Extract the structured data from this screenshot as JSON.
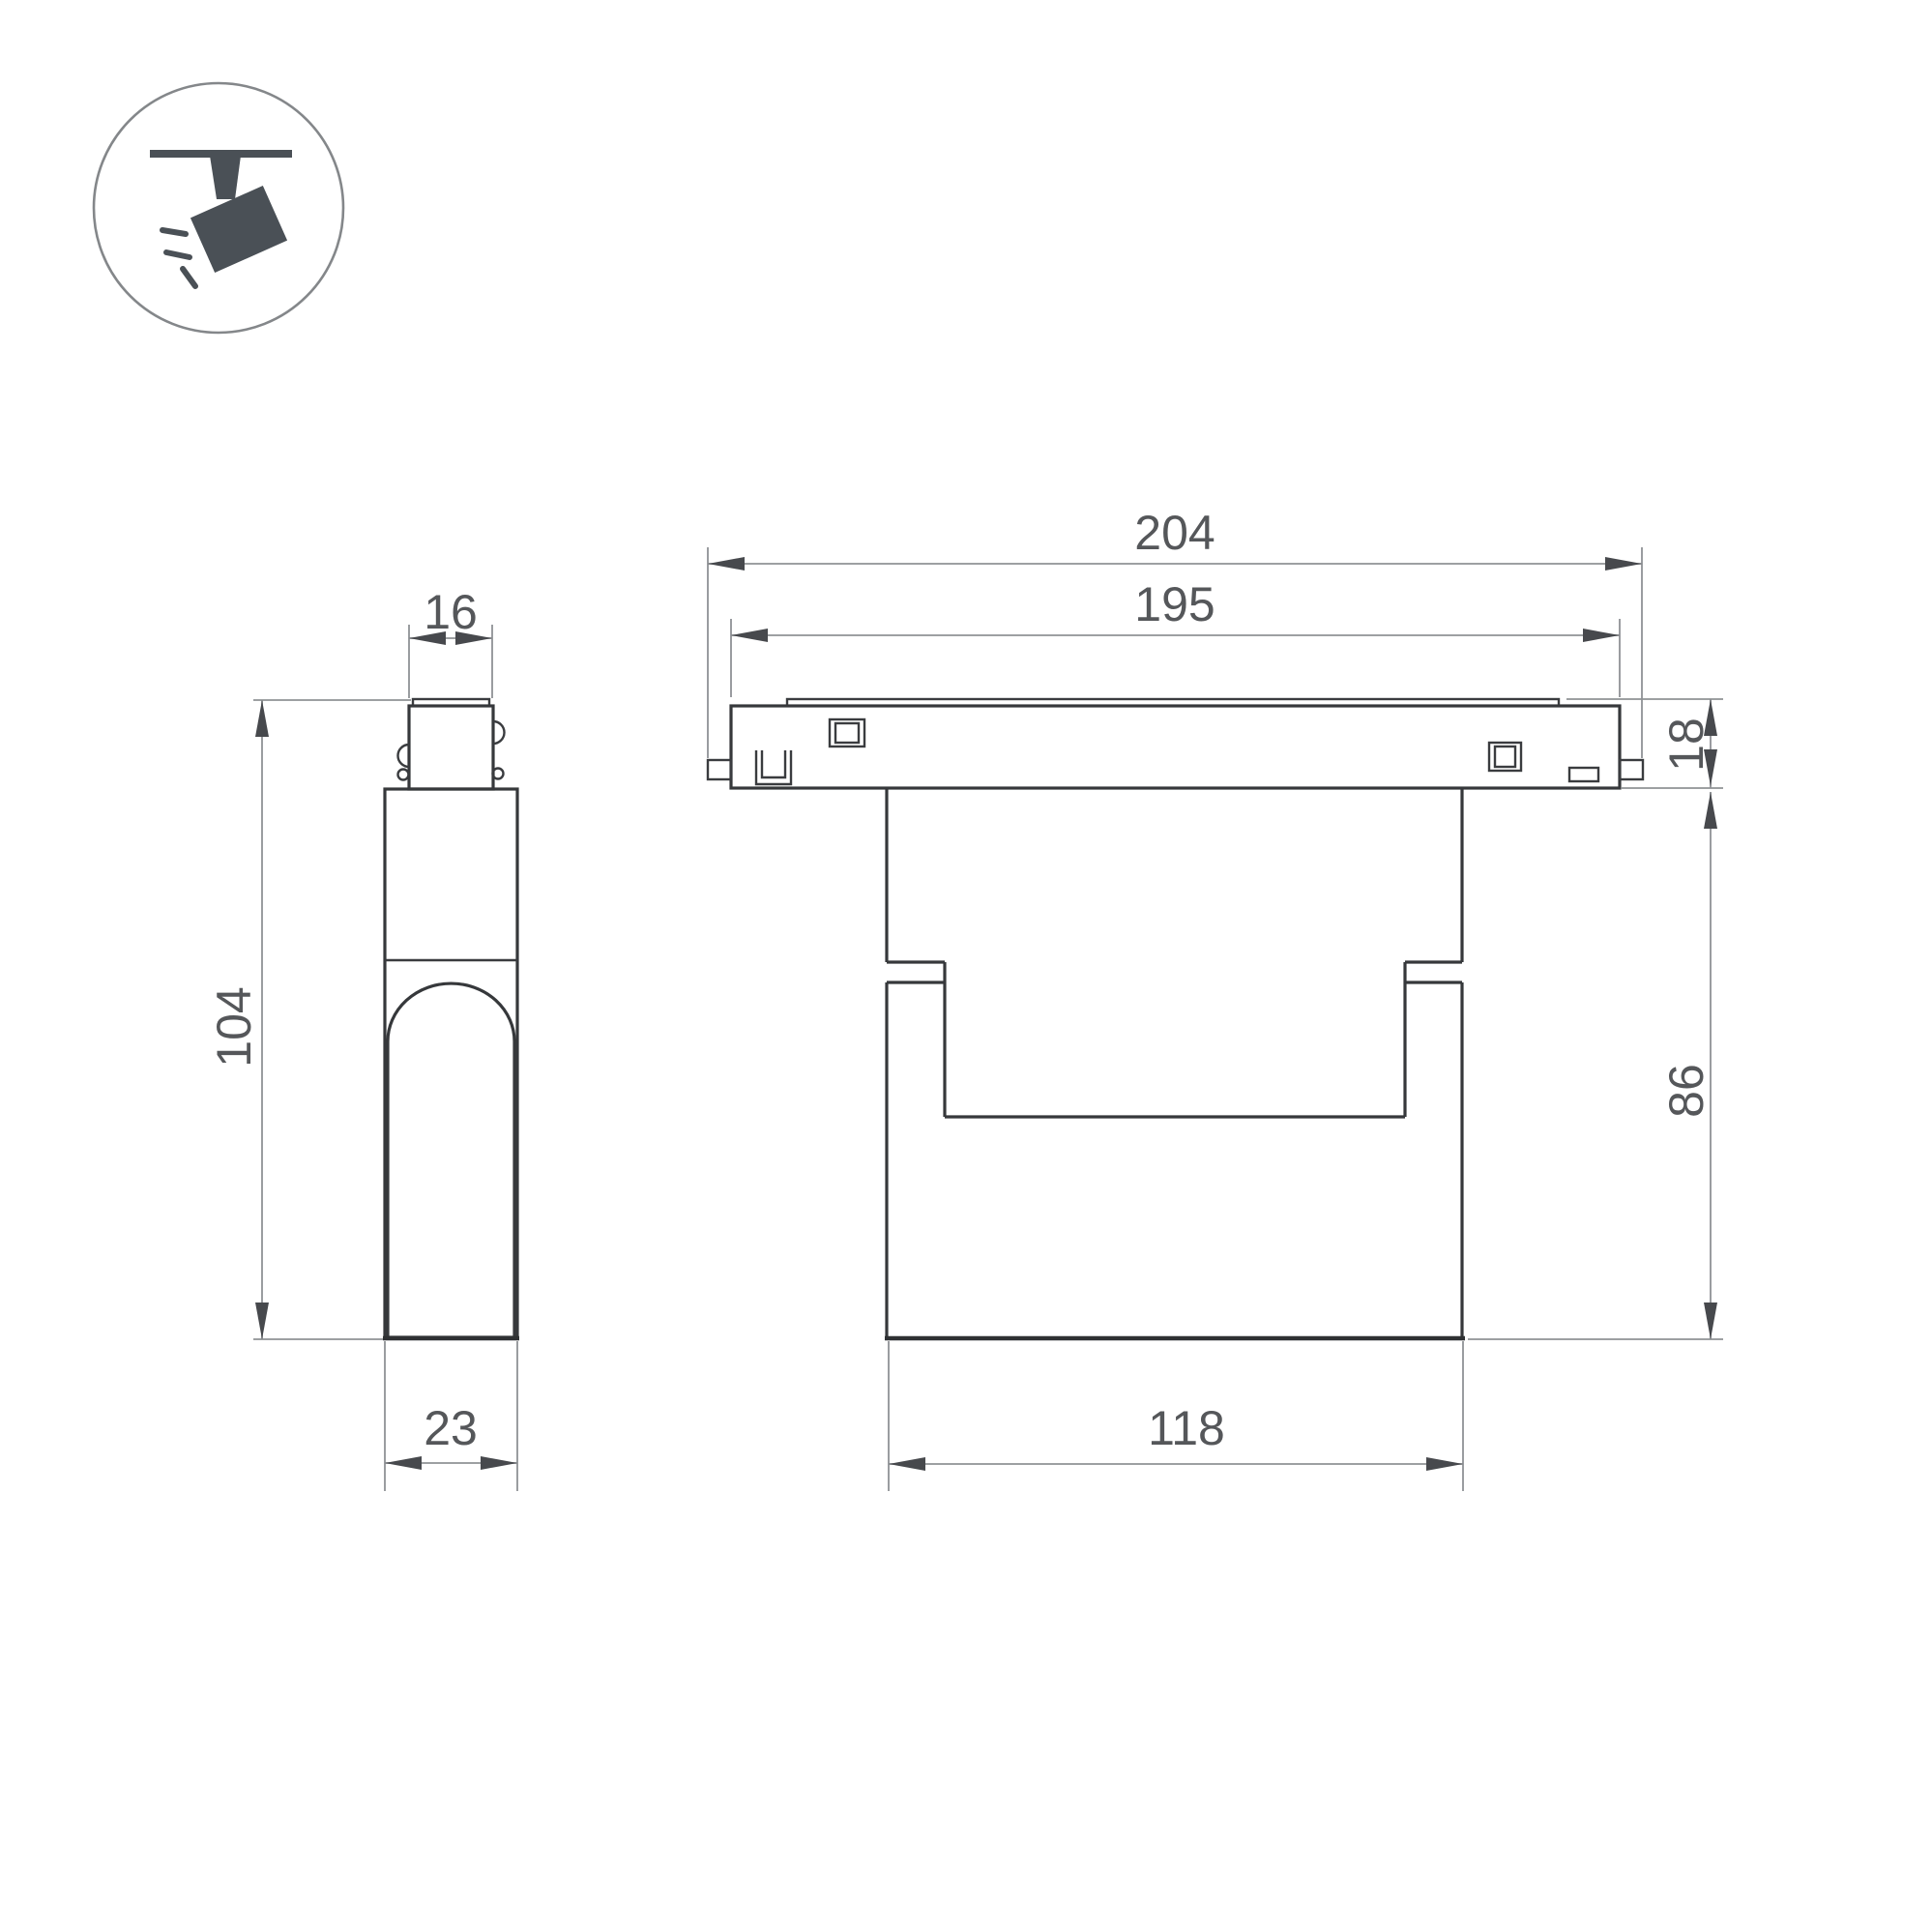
{
  "icon": {
    "name": "track-spotlight-icon",
    "fill_color": "#4a5056",
    "circle_stroke_color": "#84878a"
  },
  "drawing": {
    "outline_color": "#36383b",
    "dimension_line_color": "#8f9295",
    "arrow_color": "#47494d",
    "label_color": "#55575a",
    "views": {
      "side_view": "side-view",
      "front_view": "front-view"
    }
  },
  "dims": {
    "connector_width": "16",
    "total_height": "104",
    "body_depth": "23",
    "track_length_total": "204",
    "track_length_body": "195",
    "track_height": "18",
    "lamp_height": "86",
    "lamp_width": "118"
  }
}
